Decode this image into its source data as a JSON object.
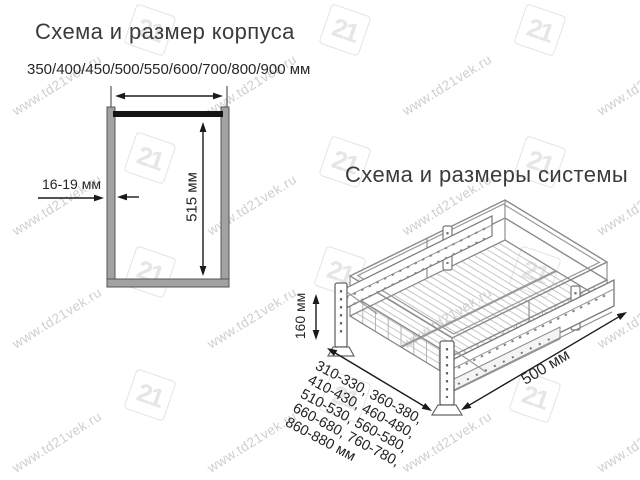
{
  "watermark": {
    "text": "www.td21vek.ru",
    "logo": "21"
  },
  "body_diagram": {
    "title": "Схема и размер корпуса",
    "width_options": "350/400/450/500/550/600/700/800/900 мм",
    "height": "515 мм",
    "panel_thickness": "16-19 мм"
  },
  "system_diagram": {
    "title": "Схема и размеры системы",
    "height": "160 мм",
    "depth": "500 мм",
    "width_ranges": [
      "310-330, 360-380,",
      "410-430, 460-480,",
      "510-530, 560-580,",
      "660-680, 760-780,",
      "860-880 мм"
    ]
  }
}
